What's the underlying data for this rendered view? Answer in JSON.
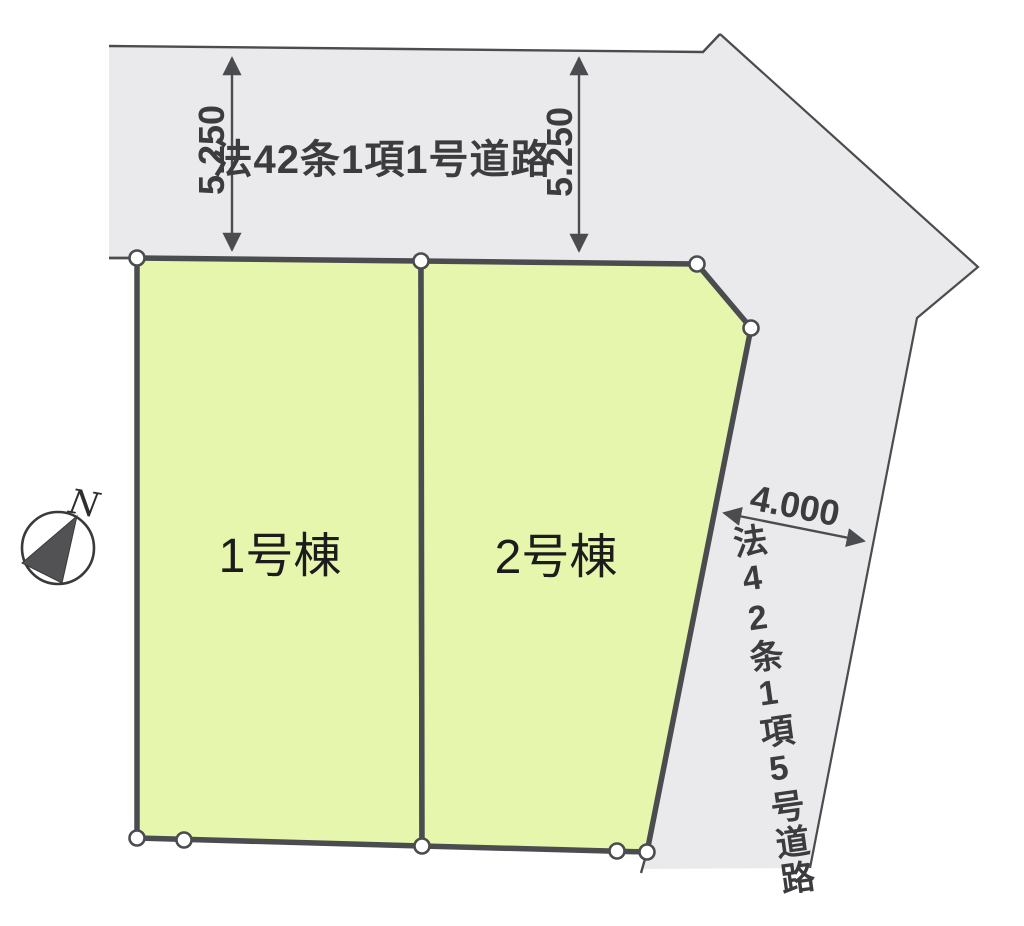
{
  "colors": {
    "background": "#ffffff",
    "road_fill": "#eaeaec",
    "lot_fill": "#e6f6ac",
    "line": "#4b4c4f",
    "text": "#3c3c3e"
  },
  "compass": {
    "label": "N"
  },
  "roads": {
    "top": {
      "name": "法42条1項1号道路",
      "dim_left": "5.250",
      "dim_right": "5.250"
    },
    "right": {
      "name": "法42条1項5号道路",
      "dim": "4.000"
    }
  },
  "lots": [
    {
      "label": "1号棟"
    },
    {
      "label": "2号棟"
    }
  ]
}
